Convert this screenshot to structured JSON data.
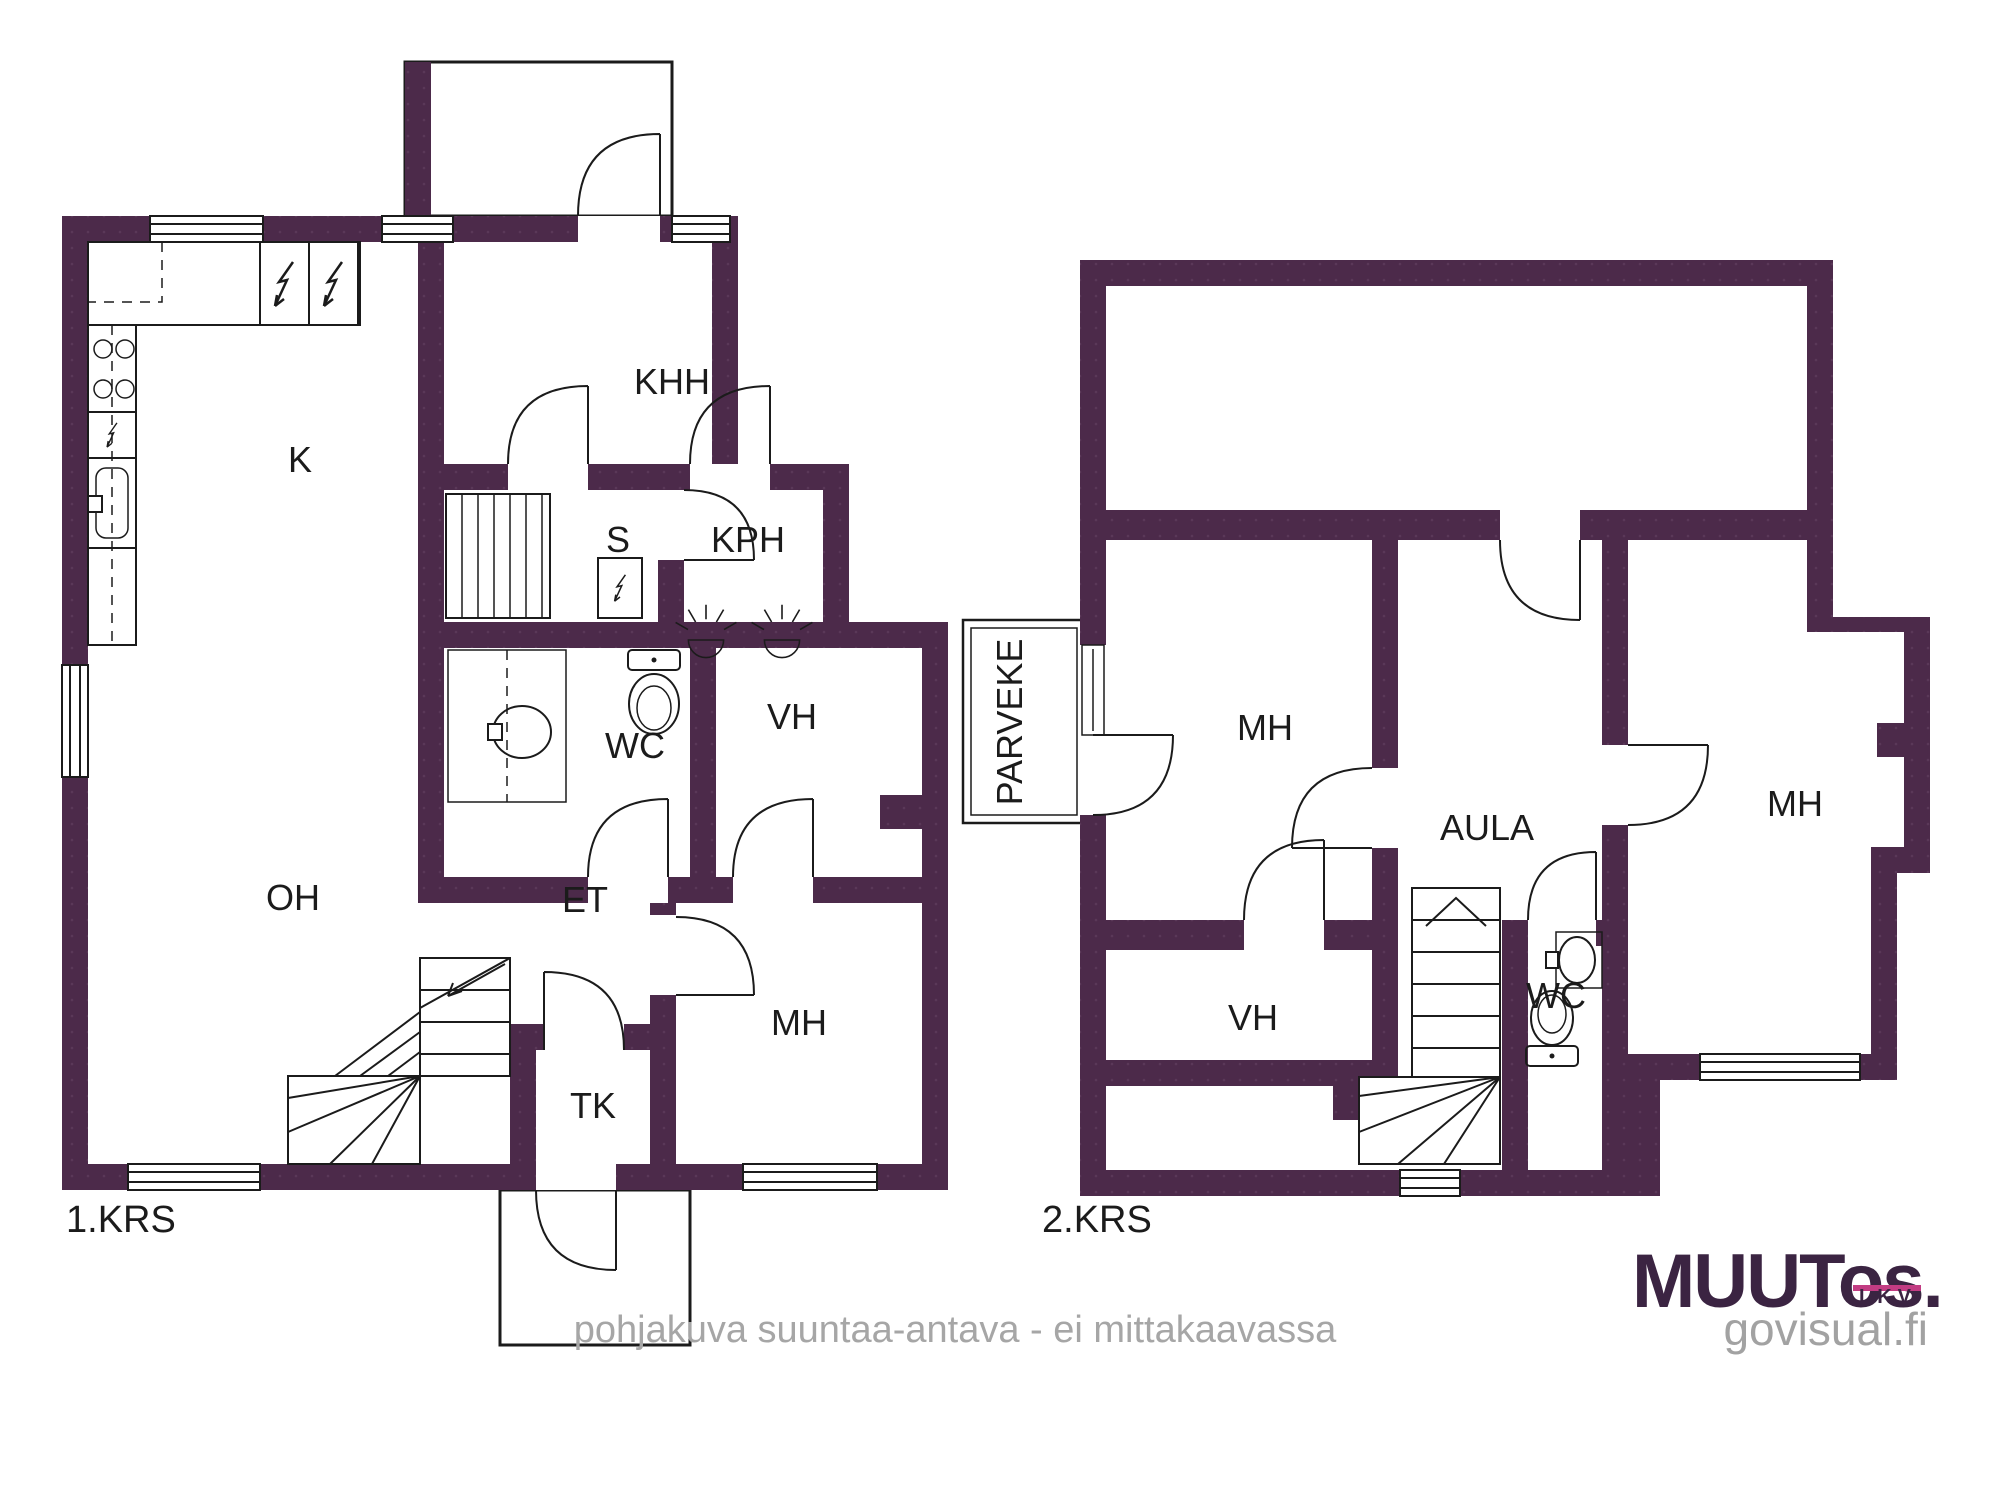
{
  "colors": {
    "wall": "#4c2a4a",
    "wall_dot": "#5a3858",
    "line": "#1b1b1b",
    "footer_gray": "#a6a6a6",
    "logo_dark": "#3b2442",
    "logo_pink": "#c23c83",
    "logo_gray": "#a2a2a2"
  },
  "floor1": {
    "title": "1.KRS",
    "rooms": [
      {
        "label": "K"
      },
      {
        "label": "KHH"
      },
      {
        "label": "S"
      },
      {
        "label": "KPH"
      },
      {
        "label": "WC"
      },
      {
        "label": "VH"
      },
      {
        "label": "OH"
      },
      {
        "label": "ET"
      },
      {
        "label": "MH"
      },
      {
        "label": "TK"
      }
    ]
  },
  "floor2": {
    "title": "2.KRS",
    "rooms": [
      {
        "label": "PARVEKE"
      },
      {
        "label": "MH"
      },
      {
        "label": "AULA"
      },
      {
        "label": "WC"
      },
      {
        "label": "VH"
      },
      {
        "label": "MH"
      }
    ]
  },
  "footer": {
    "note": "pohjakuva suuntaa-antava - ei mittakaavassa"
  },
  "logo": {
    "word": "MUUT",
    "suffix": "os.",
    "sub": "LKV",
    "site": "govisual.fi"
  }
}
